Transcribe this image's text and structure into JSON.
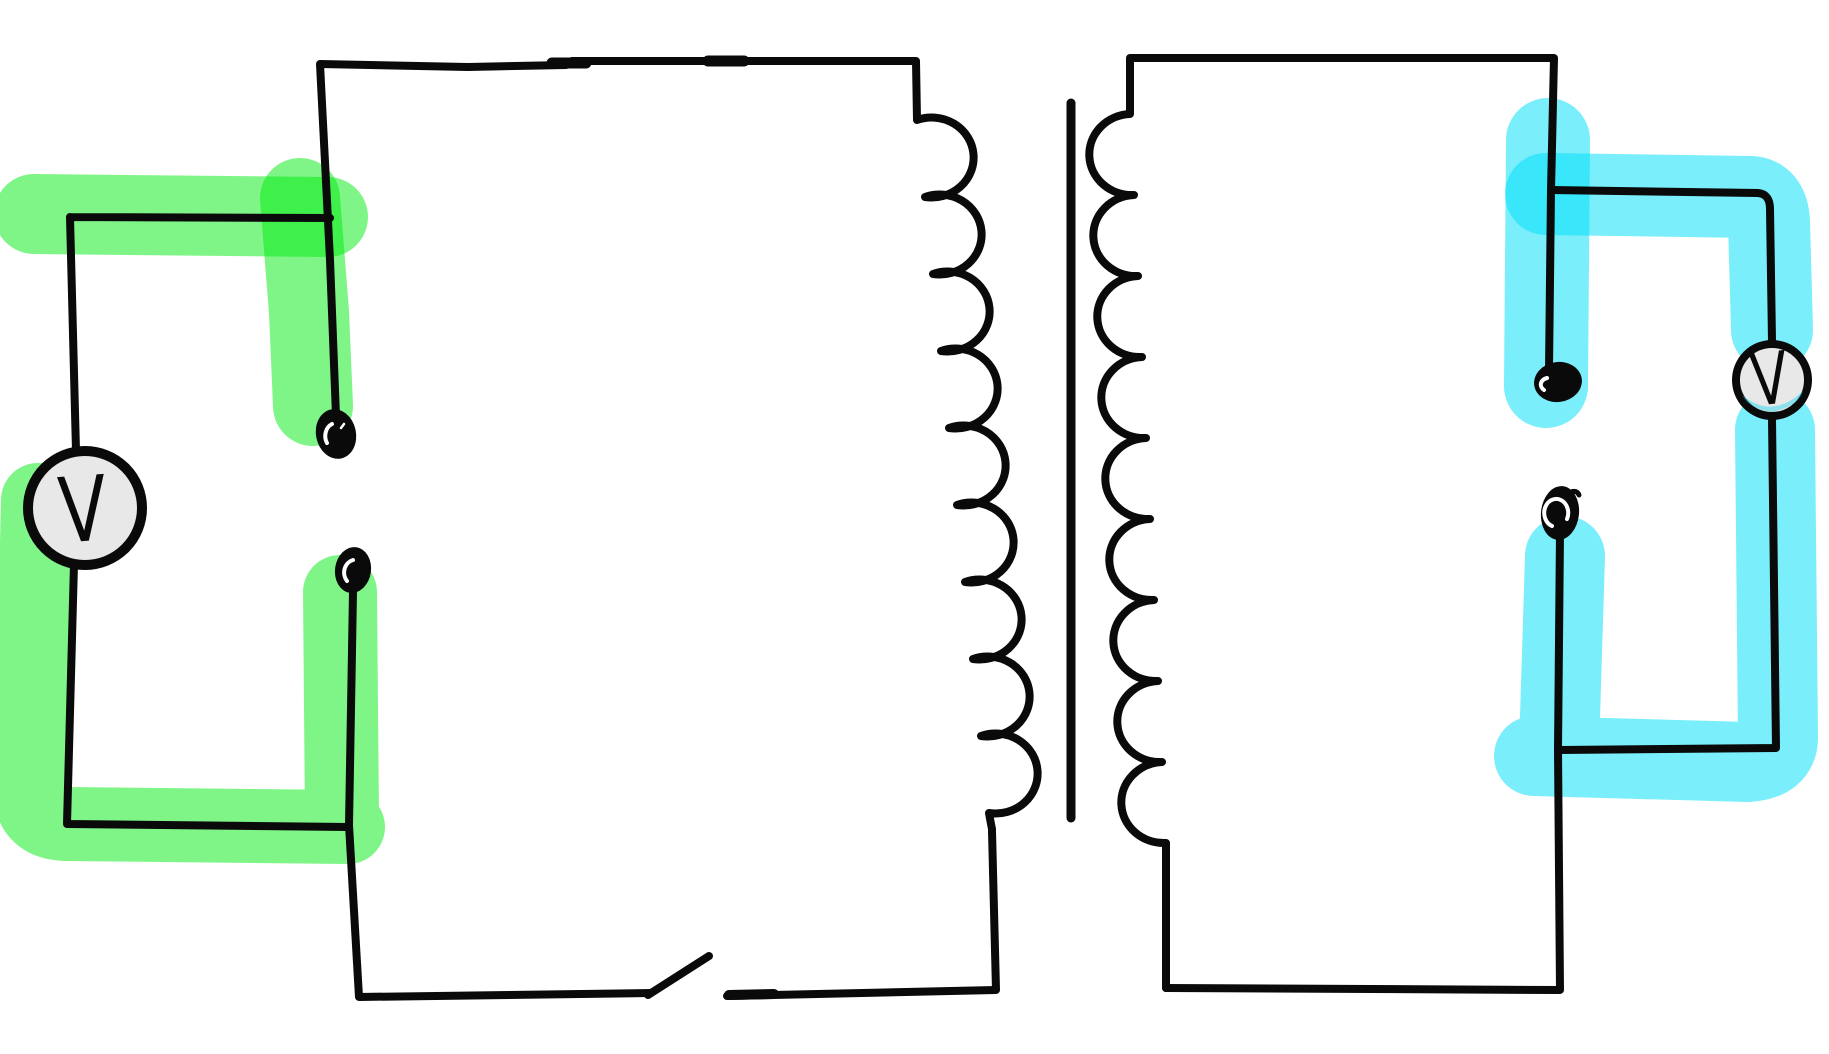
{
  "voltmeters": {
    "left": {
      "label": "V"
    },
    "right": {
      "label": "V"
    }
  },
  "colors": {
    "background": "#ffffff",
    "wire": "#0a0a0a",
    "green_highlight": "rgba(0,235,15,0.5)",
    "cyan_highlight": "rgba(0,222,248,0.52)",
    "meter_fill": "#e8e8e8",
    "meter_cyan_tint": "rgba(0,214,240,0.4)"
  }
}
